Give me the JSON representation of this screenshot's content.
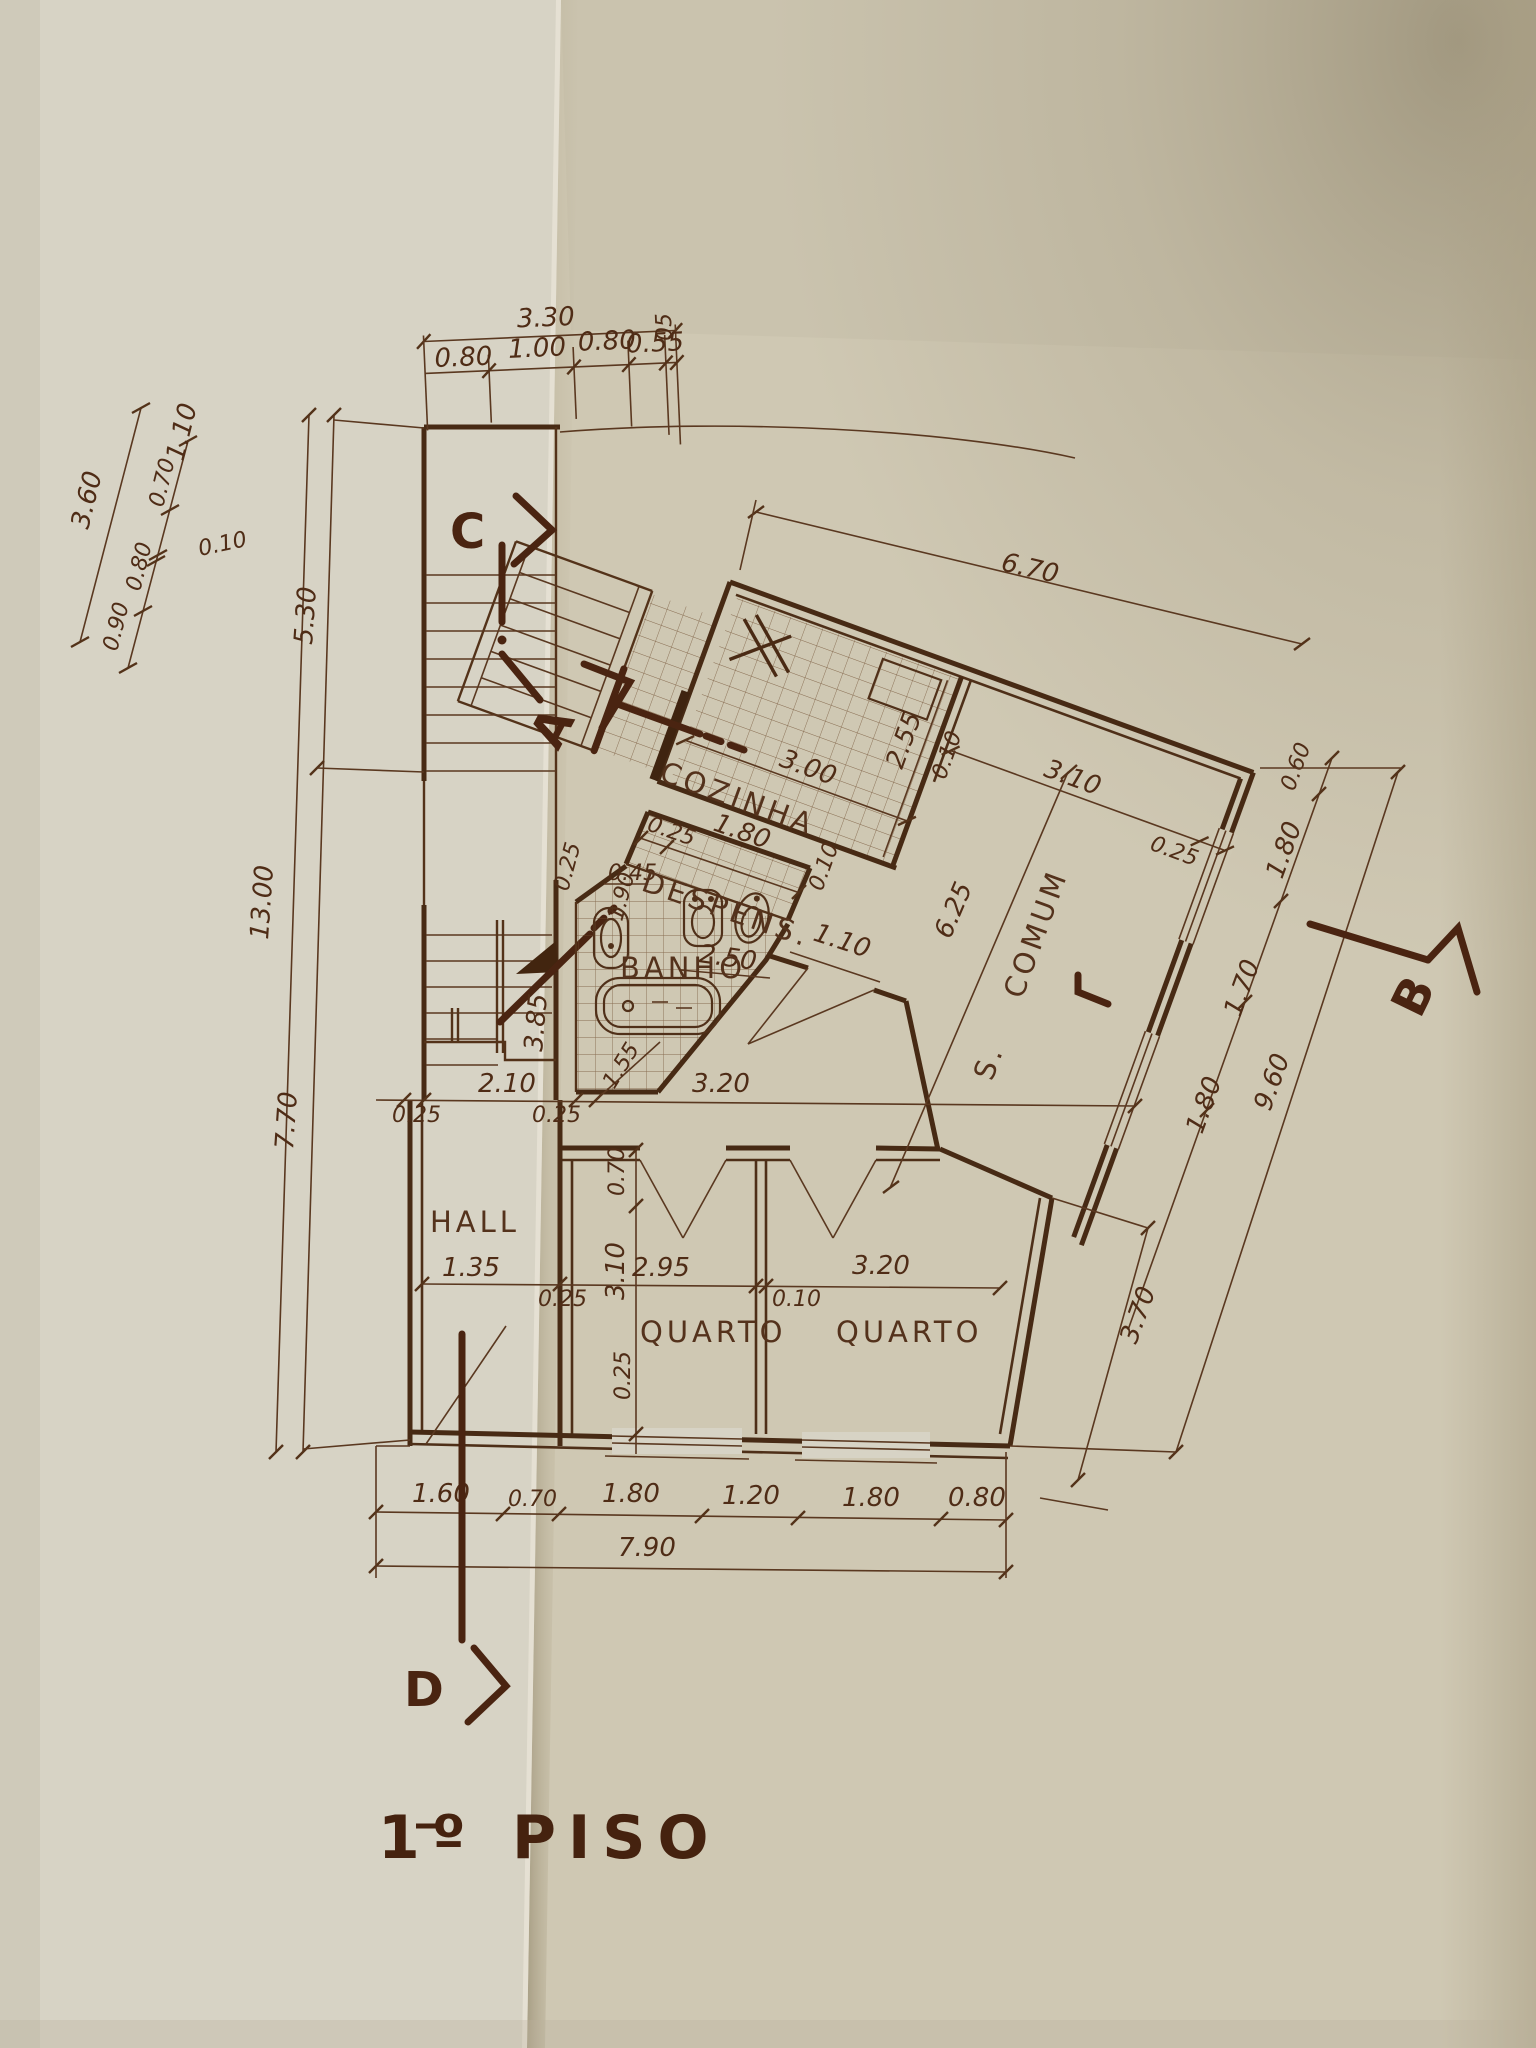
{
  "title": {
    "number": "1º",
    "word": "PISO"
  },
  "markers": {
    "a": "A",
    "b": "B",
    "c": "C",
    "d": "D"
  },
  "rooms": {
    "cozinha": "COZINHA",
    "despensa": "DESPENS.",
    "banho": "BANHO",
    "hall": "HALL",
    "quarto1": "QUARTO",
    "quarto2": "QUARTO",
    "comum": "COMUM",
    "comum_s": "S."
  },
  "dims": {
    "top_total": "3.30",
    "top": [
      "0.80",
      "1.00",
      "0.80",
      "0.55",
      "05"
    ],
    "left_diag_total": "3.60",
    "left_diag": [
      "1.10",
      "0.70",
      "0.10",
      "0.80",
      "0.90"
    ],
    "left_total": "13.00",
    "left_upper": "5.30",
    "left_lower": "7.70",
    "wing_top": "6.70",
    "kitchen_w": "3.00",
    "kitchen_d": "2.55",
    "kitchen_wall": "0.10",
    "comum_w": "3.10",
    "comum_wall": "0.25",
    "comum_len": "6.25",
    "desp_wall": "0.25",
    "desp_w": "1.80",
    "desp_side": "0.10",
    "bath_wall": "0.25",
    "bath_niche": "0.45",
    "bath_d": "1.90",
    "bath_w": "2.50",
    "comum_door": "1.10",
    "mid": [
      "0.25",
      "2.10",
      "0.25",
      "1.55",
      "3.20"
    ],
    "fold_v": "3.85",
    "right_inner": [
      "0.60",
      "1.80",
      "1.70",
      "1.80"
    ],
    "right_outer": "9.60",
    "right_low": "3.70",
    "q_left": [
      "0.70",
      "3.10",
      "0.25"
    ],
    "q_row": [
      "0.25",
      "2.95",
      "0.10",
      "3.20"
    ],
    "hall_w": "1.35",
    "bottom": [
      "1.60",
      "0.70",
      "1.80",
      "1.20",
      "1.80",
      "0.80"
    ],
    "bottom_total": "7.90"
  },
  "colors": {
    "paper_left": "#d7d3c5",
    "paper_right": "#cfc8b3",
    "ink": "#4f2c16"
  }
}
